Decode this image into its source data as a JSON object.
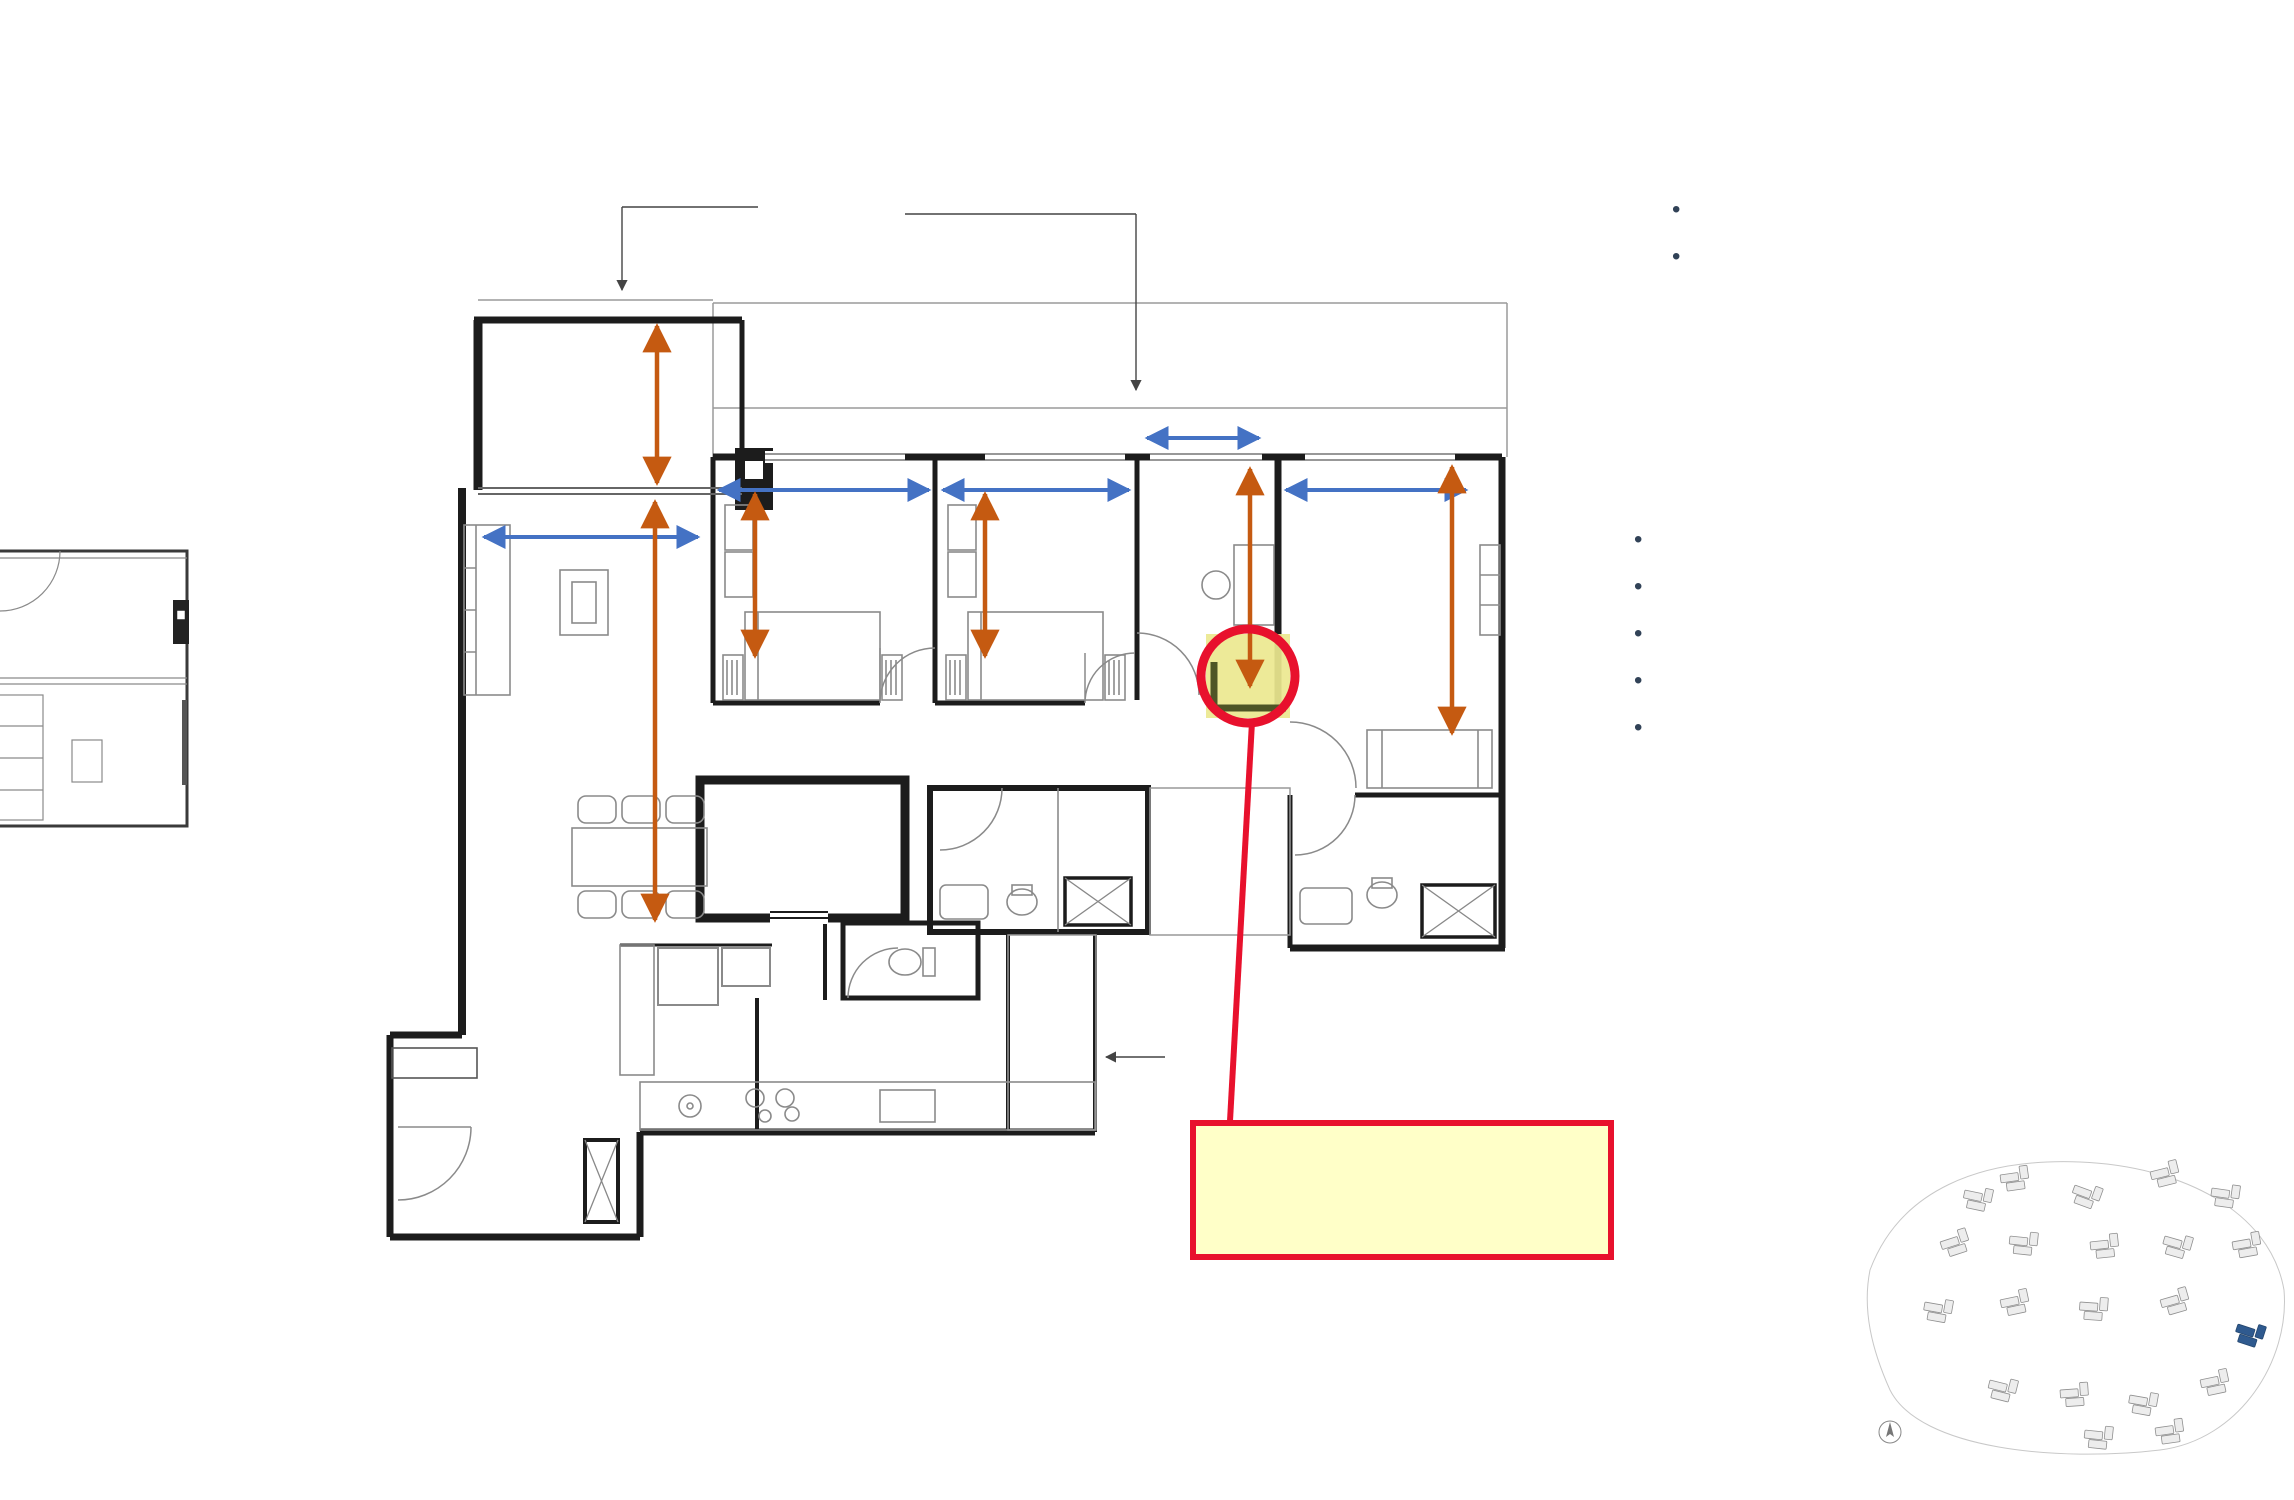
{
  "header": {
    "title": "BEDROOM PREMIUM + STUDY",
    "type1": {
      "name": "PE CPS1",
      "area": "8 sqm / 1163 sqft",
      "units": "19 #03-93 to #12-93"
    },
    "type2": {
      "name": "PE CPS1(p)",
      "area": "sqm / 1163 sqft",
      "units": "19 #02-93"
    },
    "mini_plan": {
      "rooms": [
        "PES",
        "LIVING"
      ],
      "note": "NOT TO SCALE"
    }
  },
  "logo": {
    "line1": "PARK",
    "line2": "TOWN",
    "line3": "RESIDENCE"
  },
  "appliances": [
    "Standalone Washer & Dryer",
    "Fridge (617L)"
  ],
  "finishes": [
    {
      "title": "Tier 2 Finishes",
      "details": []
    },
    {
      "title": "Living / Dining",
      "details": [
        "(Polished Tile 1200mm x 600mm)"
      ]
    },
    {
      "title": "Kitchen",
      "details": [
        "(Tile 600mm x 600mm)",
        "Backsplash (Tile 1500mm x 750mm)",
        "Counter Top (Quartz)"
      ]
    },
    {
      "title": "Bedroom / Study",
      "details": [
        "Timber (1200mm x 70mm x 12mm)"
      ]
    },
    {
      "title": "Bath",
      "details": [
        "Counter Top (Solid Surface)"
      ]
    }
  ],
  "floorplan": {
    "rooms": [
      {
        "label": "BALCONY",
        "area": "7.4"
      },
      {
        "label": "LIVING",
        "area": "34.6",
        "ch": "CH 2.79M"
      },
      {
        "label": "BEDROOM 3",
        "area": "9"
      },
      {
        "label": "BEDROOM 2",
        "area": "9"
      },
      {
        "label": "STUDY",
        "area": "5.8"
      },
      {
        "line1": "MASTER",
        "line2": "BEDROOM",
        "area": "13.9"
      },
      {
        "label": "DINING"
      },
      {
        "label": "KITCHEN",
        "area": "12.1"
      },
      {
        "label": "YARD"
      },
      {
        "label": "BATH 2",
        "area": "4.5"
      },
      {
        "line1": "MASTER",
        "line2": "BATH",
        "area": "5.3"
      },
      {
        "label": "HS",
        "area": "3.8"
      },
      {
        "label": "WC",
        "area": "1.6"
      },
      {
        "label": "W+D"
      },
      {
        "label": "F"
      },
      {
        "label": "DB/ST",
        "area": "0.6"
      }
    ],
    "dims": [
      "2200",
      "3000",
      "2600",
      "2600",
      "1600",
      "2800",
      "2450",
      "2450",
      "3100",
      "3600",
      "5725"
    ],
    "rc_ledge": [
      "RC LEDGE",
      "APPLICABLE AT",
      "3RD STOREY TO 12TH STOREY"
    ],
    "ac_ledge": [
      "AC LEDGE",
      "(non-strata)"
    ],
    "hob": "H"
  },
  "callout": {
    "lines": [
      "Potential to convert study",
      "as part of master suite.",
      "Refer to show unit."
    ]
  },
  "disclaimer": [
    "** ALL SIZE & DIMENSIONS ARE ESTIMATED, SOLELY FOR REFERENCE PURPOSE AND WILL NOT",
    "FORM PART OF THE CONDITIONS FOR THE SALES AND PURCHASE OF THE PROPERTY."
  ],
  "key_plan": {
    "entrance_label": "Entrance",
    "street_label": "Tampines Street 62",
    "note_lines": [
      "KEY PLAN IS",
      "NOT TO SCALE"
    ],
    "block_numbers": [
      "1",
      "3",
      "5",
      "7",
      "9",
      "15",
      "17",
      "19",
      "21",
      "23"
    ]
  },
  "colors": {
    "accent_green": "#1d5147",
    "dim_blue": "#4472c4",
    "dim_orange": "#c55a11",
    "value_red": "#e8112d",
    "callout_fill": "#ffffc8",
    "text_navy": "#314257"
  }
}
